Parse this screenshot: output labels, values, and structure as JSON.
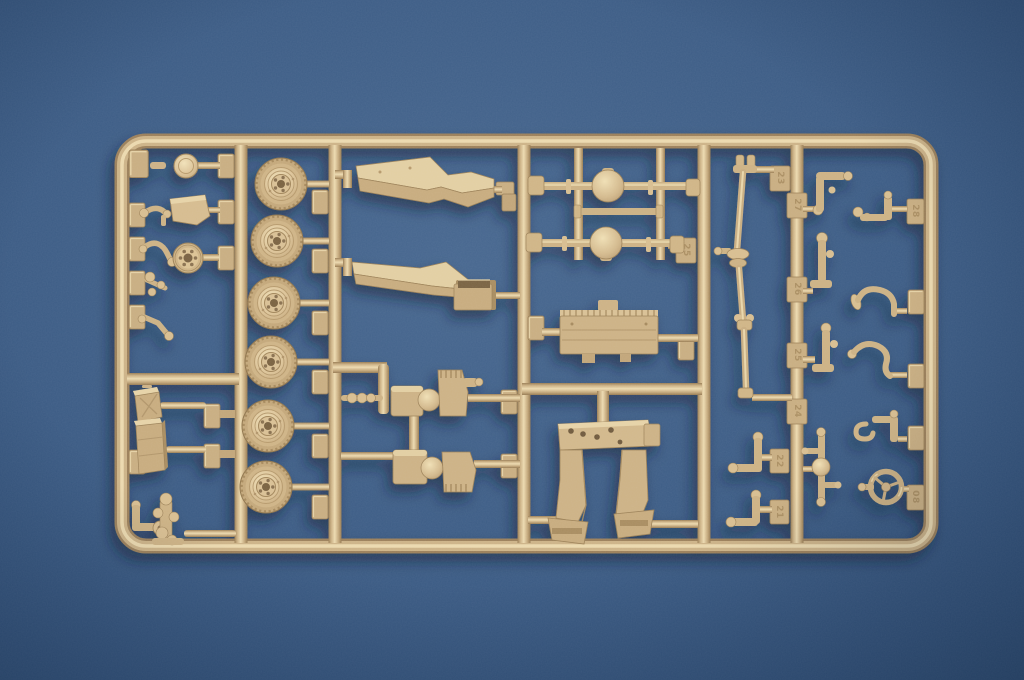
{
  "scene": {
    "type": "photograph",
    "description": "Macro photo of an injection-moulded model-kit sprue (parts tree) of tan styrene parts for a military vehicle kit, lying slightly tilted on a blue textured backdrop",
    "background": "plain blue fabric-textured surface",
    "lighting": "soft studio light, parts cast small shadows to lower left"
  },
  "colors": {
    "background_blue": "#3c5c85",
    "background_corner": "#2a4a70",
    "plastic_base": "#d0b586",
    "plastic_highlight": "#eedbb0",
    "plastic_shadow": "#9c805a",
    "cast_shadow": "#101f36"
  },
  "sprue": {
    "material": "tan styrene",
    "layout": "rectangular outer frame with five internal vertical runners dividing six part bays",
    "part_number_tabs": [
      {
        "label": "23"
      },
      {
        "label": "27"
      },
      {
        "label": "26"
      },
      {
        "label": "25"
      },
      {
        "label": "24"
      },
      {
        "label": "22"
      },
      {
        "label": "21"
      },
      {
        "label": "25"
      },
      {
        "label": "28"
      },
      {
        "label": "08"
      }
    ],
    "parts_inventory": [
      {
        "part": "road wheel with ribbed hub",
        "count": 6
      },
      {
        "part": "stepped fender panel",
        "count": 2
      },
      {
        "part": "axle with differential housing",
        "count": 2
      },
      {
        "part": "plain axle rod",
        "count": 1
      },
      {
        "part": "multi-section drive shaft with universal joints",
        "count": 1
      },
      {
        "part": "gearbox / transfer-case assembly",
        "count": 2
      },
      {
        "part": "ribbed radiator / firewall panel",
        "count": 1
      },
      {
        "part": "carriage legs with drilled top plate",
        "count": 1
      },
      {
        "part": "steering wheel",
        "count": 1
      },
      {
        "part": "steering cross shaft",
        "count": 1
      },
      {
        "part": "brake drum",
        "count": 1
      },
      {
        "part": "headlight",
        "count": 1
      },
      {
        "part": "seat back plate",
        "count": 1
      },
      {
        "part": "jerry can",
        "count": 1
      },
      {
        "part": "stowage box",
        "count": 1
      },
      {
        "part": "hand crank",
        "count": 1
      },
      {
        "part": "small levers, pedals and brackets",
        "count": 16
      }
    ]
  }
}
